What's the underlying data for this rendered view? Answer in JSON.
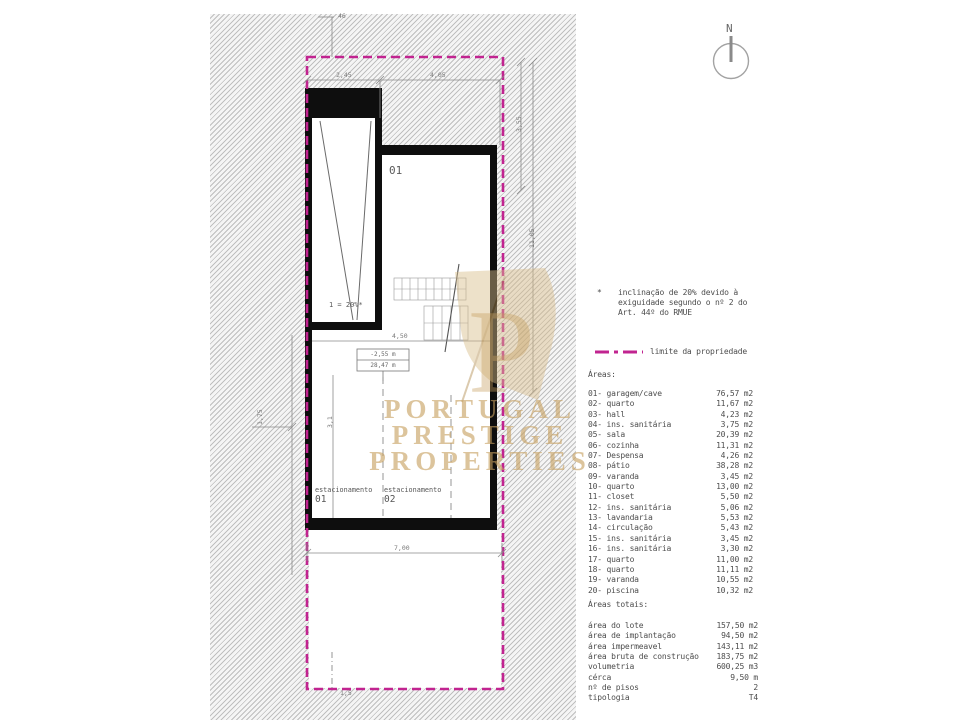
{
  "colors": {
    "magenta": "#c12490",
    "gold": "#c6a060",
    "wall": "#0e0e0e",
    "hatch_line": "#bfbfbf",
    "text": "#4d4d4d"
  },
  "north": {
    "label": "N"
  },
  "watermark": {
    "line1": "PORTUGAL PRESTIGE",
    "line2": "PROPERTIES",
    "monogram": "P"
  },
  "plan": {
    "room01_label": "01",
    "ramp_label": "1 = 20%*",
    "level_box": {
      "top": "-2,55 m",
      "bottom": "28,47 m"
    },
    "parking1": {
      "label": "estacionamento",
      "number": "01"
    },
    "parking2": {
      "label": "estacionamento",
      "number": "02"
    },
    "dims": {
      "top_tick": "46",
      "top_left": "2,45",
      "top_right": "4,05",
      "right_upper": "3,55",
      "right_lower": "11,05",
      "left_height": "1,75",
      "garage_width": "3,1",
      "inner_width": "4,50",
      "bottom_width": "7,00",
      "courtyard": "1,5"
    }
  },
  "legend": {
    "note": {
      "bullet": "*",
      "line1": "inclinação de 20% devido à",
      "line2": "exiguidade segundo o nº 2 do",
      "line3": "Art. 44º do RMUE"
    },
    "boundary_label": "limite da propriedade",
    "areas_title": "Áreas:",
    "areas": [
      {
        "id": "01-",
        "name": "garagem/cave",
        "value": "76,57 m2"
      },
      {
        "id": "02-",
        "name": "quarto",
        "value": "11,67 m2"
      },
      {
        "id": "03-",
        "name": "hall",
        "value": "4,23 m2"
      },
      {
        "id": "04-",
        "name": "ins. sanitária",
        "value": "3,75 m2"
      },
      {
        "id": "05-",
        "name": "sala",
        "value": "20,39 m2"
      },
      {
        "id": "06-",
        "name": "cozinha",
        "value": "11,31 m2"
      },
      {
        "id": "07-",
        "name": "Despensa",
        "value": "4,26 m2"
      },
      {
        "id": "08-",
        "name": "pátio",
        "value": "38,28 m2"
      },
      {
        "id": "09-",
        "name": "varanda",
        "value": "3,45 m2"
      },
      {
        "id": "10-",
        "name": "quarto",
        "value": "13,00 m2"
      },
      {
        "id": "11-",
        "name": "closet",
        "value": "5,50 m2"
      },
      {
        "id": "12-",
        "name": "ins. sanitária",
        "value": "5,06 m2"
      },
      {
        "id": "13-",
        "name": "lavandaria",
        "value": "5,53 m2"
      },
      {
        "id": "14-",
        "name": "circulação",
        "value": "5,43 m2"
      },
      {
        "id": "15-",
        "name": "ins. sanitária",
        "value": "3,45 m2"
      },
      {
        "id": "16-",
        "name": "ins. sanitária",
        "value": "3,30 m2"
      },
      {
        "id": "17-",
        "name": "quarto",
        "value": "11,00 m2"
      },
      {
        "id": "18-",
        "name": "quarto",
        "value": "11,11 m2"
      },
      {
        "id": "19-",
        "name": "varanda",
        "value": "10,55 m2"
      },
      {
        "id": "20-",
        "name": "piscina",
        "value": "10,32 m2"
      }
    ],
    "totals_title": "Áreas totais:",
    "totals": [
      {
        "name": "área do lote",
        "value": "157,50 m2"
      },
      {
        "name": "área de implantação",
        "value": "94,50 m2"
      },
      {
        "name": "área impermeavel",
        "value": "143,11 m2"
      },
      {
        "name": "área bruta de construção",
        "value": "183,75 m2"
      },
      {
        "name": "volumetria",
        "value": "600,25 m3"
      },
      {
        "name": "cérca",
        "value": "9,50 m"
      },
      {
        "name": "nº de pisos",
        "value": "2"
      },
      {
        "name": "tipologia",
        "value": "T4"
      }
    ]
  }
}
